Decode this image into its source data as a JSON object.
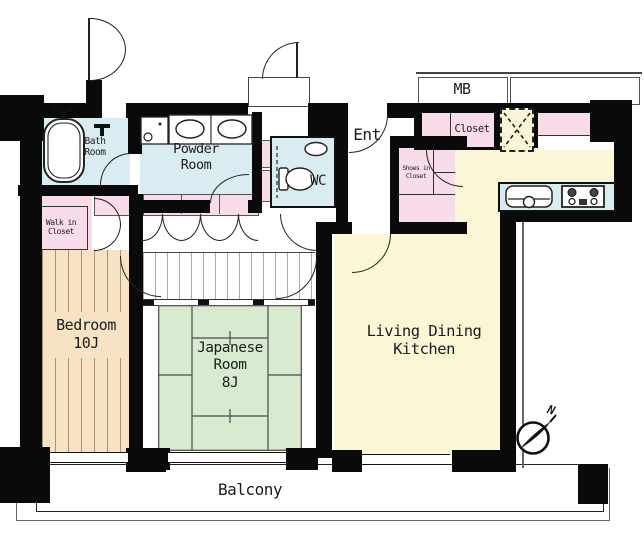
{
  "rooms": {
    "bath": {
      "label": "Bath\nRoom"
    },
    "powder": {
      "label": "Powder\nRoom"
    },
    "wc": {
      "label": "WC"
    },
    "entrance": {
      "label": "Ent"
    },
    "shoes_closet": {
      "label": "Shoes in\nCloset"
    },
    "meter_box": {
      "label": "MB"
    },
    "closet": {
      "label": "Closet"
    },
    "walk_in_closet": {
      "label": "Walk in\nCloset"
    },
    "bedroom": {
      "label": "Bedroom\n10J"
    },
    "japanese_room": {
      "label": "Japanese\nRoom\n8J"
    },
    "ldk": {
      "label": "Living Dining\nKitchen"
    },
    "balcony": {
      "label": "Balcony"
    }
  },
  "compass": {
    "north_label": "N"
  },
  "colors": {
    "wall": "#0a0a0a",
    "wet_area": "#d9ecf2",
    "closet_pink": "#f8dcea",
    "wood_floor": "#f7e3c3",
    "tatami_green": "#d8ead0",
    "ldk_yellow": "#fbf7d6",
    "ps_yellow": "#f9f5d6"
  }
}
